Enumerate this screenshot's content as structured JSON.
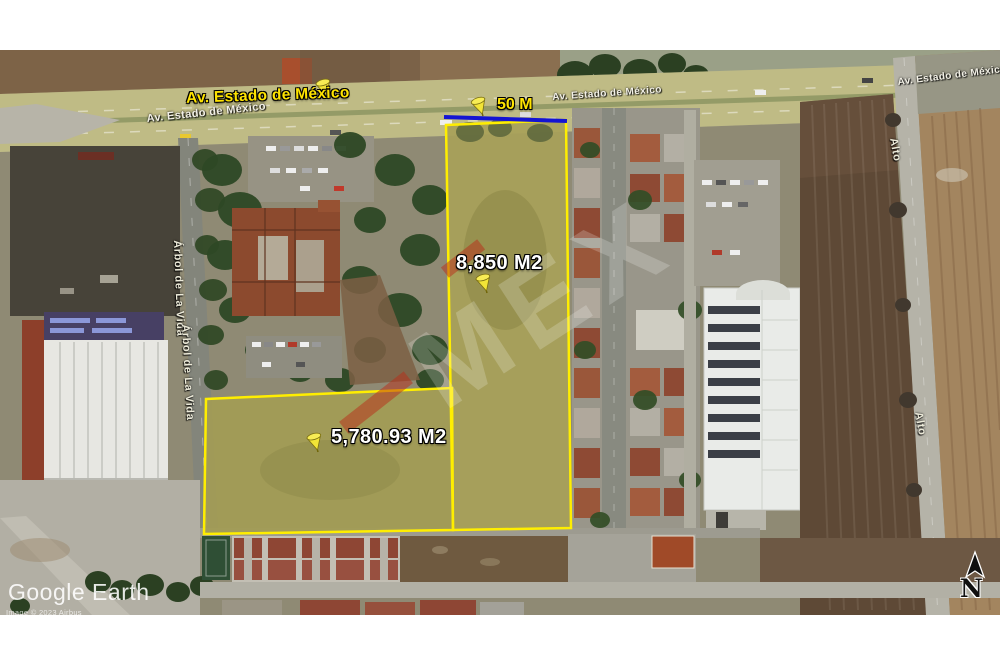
{
  "app": {
    "name": "Google Earth satellite capture"
  },
  "map": {
    "annotations": {
      "road_pin_label": "Av. Estado de México"
    },
    "road_names": {
      "left": "Av. Estado de México",
      "center": "Av. Estado de México",
      "right": "Av. Estado de México"
    },
    "measurement": {
      "label": "50 M"
    },
    "parcels": [
      {
        "area_label": "8,850 M2"
      },
      {
        "area_label": "5,780.93 M2"
      }
    ],
    "streets": {
      "arbol_1": "Árbol de La Vida",
      "arbol_2": "Árbol de La Vida",
      "alto_1": "Alto",
      "alto_2": "Alto"
    },
    "watermarks": {
      "brand": "Google Earth",
      "copyright": "Image © 2023 Airbus",
      "diagonal": "MEX"
    },
    "compass": {
      "north_letter": "N"
    }
  },
  "colors": {
    "parcel_outline": "#ffee00",
    "parcel_fill_a": "#a8a159",
    "parcel_fill_b": "#a39c55",
    "measurement_line": "#1414d2",
    "pushpin_yellow": "#f2e437",
    "label_yellow": "#ffe400",
    "road_overlay": "rgba(214,206,112,0.5)"
  }
}
